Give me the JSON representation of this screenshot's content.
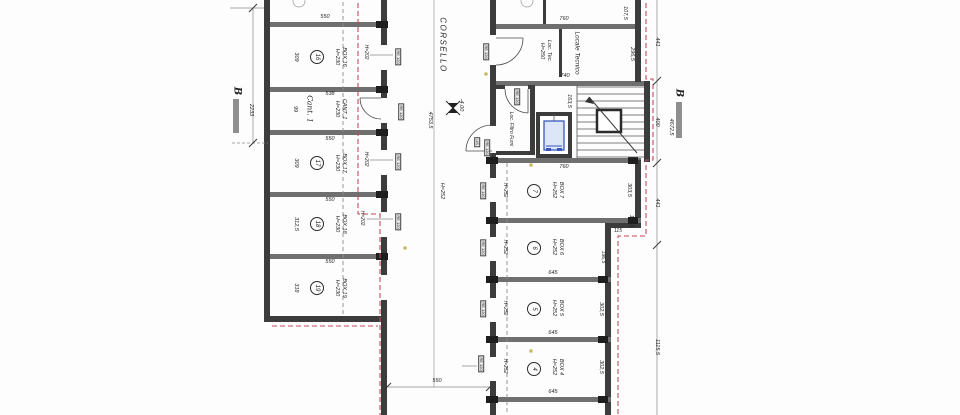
{
  "plan": {
    "corridor": {
      "name": "CORSELLO",
      "length": "4753,5",
      "level": "-4.00",
      "height": "H=252",
      "bottom_width": "550"
    },
    "section_left": {
      "label": "B",
      "dim": "2233"
    },
    "section_right": {
      "label": "B",
      "overall": "4672,5",
      "seg1": "441",
      "seg2": "400",
      "seg3": "441",
      "seg4": "1115,5"
    },
    "left_rooms": {
      "box16": {
        "num": "16",
        "name": "BOX 16",
        "h": "H=230",
        "depth": "309",
        "width": "550",
        "beam": "H=202",
        "door": "RE 120"
      },
      "cant1": {
        "script": "Cant. 1",
        "name": "CANT. 1",
        "h": "H=230",
        "width": "538",
        "depth": "99",
        "door": "RE 120"
      },
      "box17": {
        "num": "17",
        "name": "BOX 17",
        "h": "H=230",
        "depth": "309",
        "width": "550",
        "beam": "H=202",
        "door": "RE 120"
      },
      "box18": {
        "num": "18",
        "name": "BOX 18",
        "h": "H=230",
        "depth": "312,5",
        "width": "550",
        "beam": "H=202",
        "door": "RE 120"
      },
      "box19": {
        "num": "19",
        "name": "BOX 19",
        "h": "H=230",
        "depth": "318",
        "width": "550"
      }
    },
    "right_rooms": {
      "loc_tec": {
        "name": "Loc. Tec.",
        "h": "H=250",
        "width": "760",
        "door": "RE 120"
      },
      "locale_tecnico": {
        "name": "Locale Tecnico",
        "width": "740",
        "depth": "296,5",
        "corner": "107,5"
      },
      "filtro": {
        "name": "Loc. Filtro Fumi",
        "door": "RE 120",
        "exit": "US",
        "exit_door": "RE 120"
      },
      "stair_core": {
        "elev_side": "163,5"
      },
      "box7": {
        "num": "7",
        "name": "BOX 7",
        "h": "H=252",
        "beam": "H=252",
        "width": "760",
        "depth": "303,5",
        "door": "RE 120"
      },
      "box6": {
        "num": "6",
        "name": "BOX 6",
        "h": "H=252",
        "beam": "H=252",
        "width": "645",
        "step1": "105,5",
        "step2": "115",
        "step3": "196,5",
        "door": "RE 120"
      },
      "box5": {
        "num": "5",
        "name": "BOX 5",
        "h": "H=252",
        "beam": "H=252",
        "width": "645",
        "depth": "302,5",
        "door": "RE 120"
      },
      "box4": {
        "num": "4",
        "name": "BOX 4",
        "h": "H=252",
        "beam": "H=252",
        "width": "645",
        "depth": "302,5",
        "door": "RE 120"
      }
    }
  },
  "colors": {
    "wall": "#3c3c3c",
    "partition": "#6f6f6f",
    "red": "#c0485c",
    "beam": "#8b8e7f",
    "elev": "#3a57c0",
    "elevfill": "#dce6f8",
    "bar": "#8f8f8f",
    "dot": "#c6ba67"
  }
}
